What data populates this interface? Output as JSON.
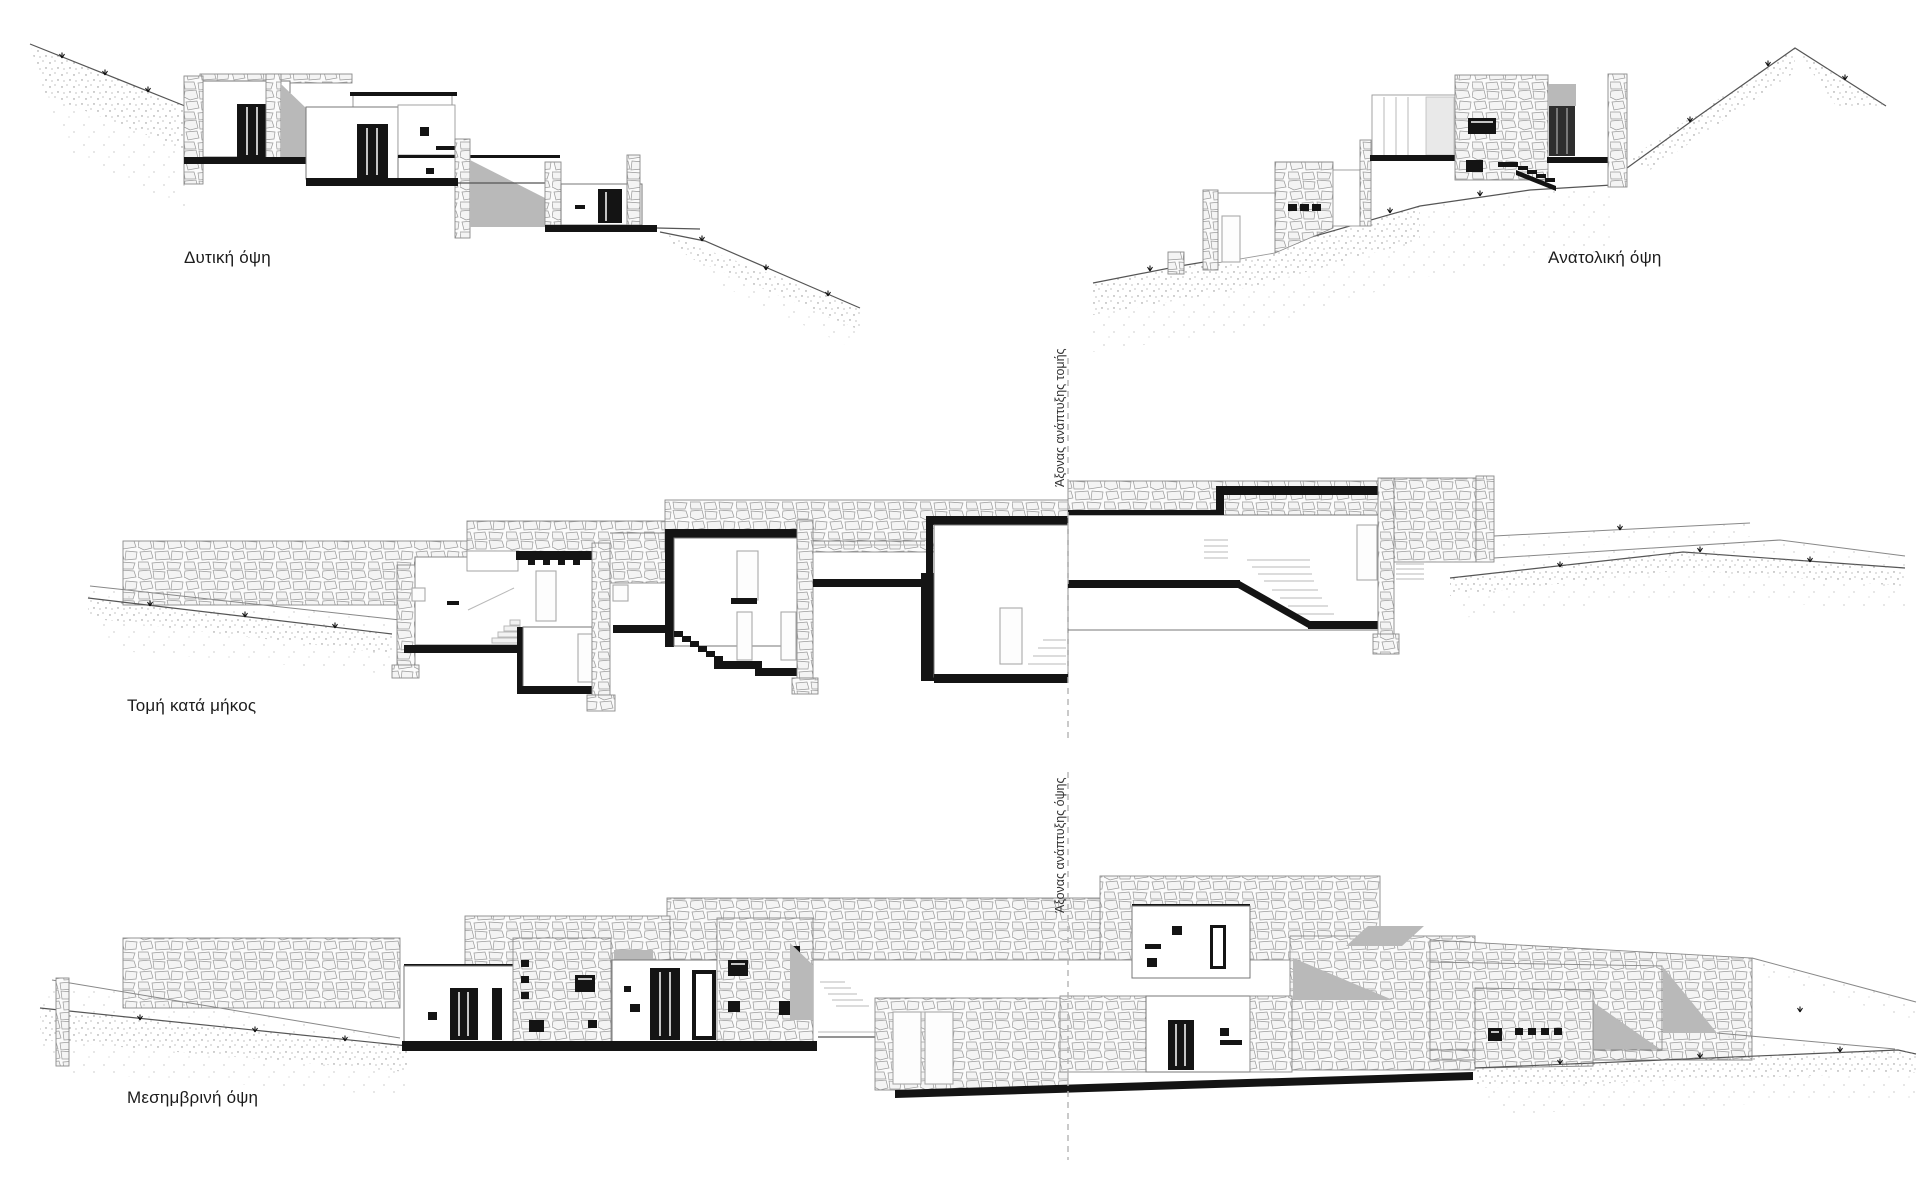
{
  "sheet": {
    "background": "#ffffff",
    "type": "architectural elevations and sections"
  },
  "palette": {
    "ink": "#141414",
    "shadow": "#b9b9b9",
    "stone_line": "#8a8a8a",
    "light_gray": "#a9a9a9",
    "axis_dash": "#b3b3b3"
  },
  "drawings": {
    "west_elevation": {
      "label": "Δυτική όψη"
    },
    "east_elevation": {
      "label": "Ανατολική όψη"
    },
    "long_section": {
      "label": "Τομή κατά μήκος",
      "axis_label": "Άξονας ανάπτυξης τομής"
    },
    "south_elevation": {
      "label": "Μεσημβρινή όψη",
      "axis_label": "Άξονας ανάπτυξης όψης"
    }
  }
}
